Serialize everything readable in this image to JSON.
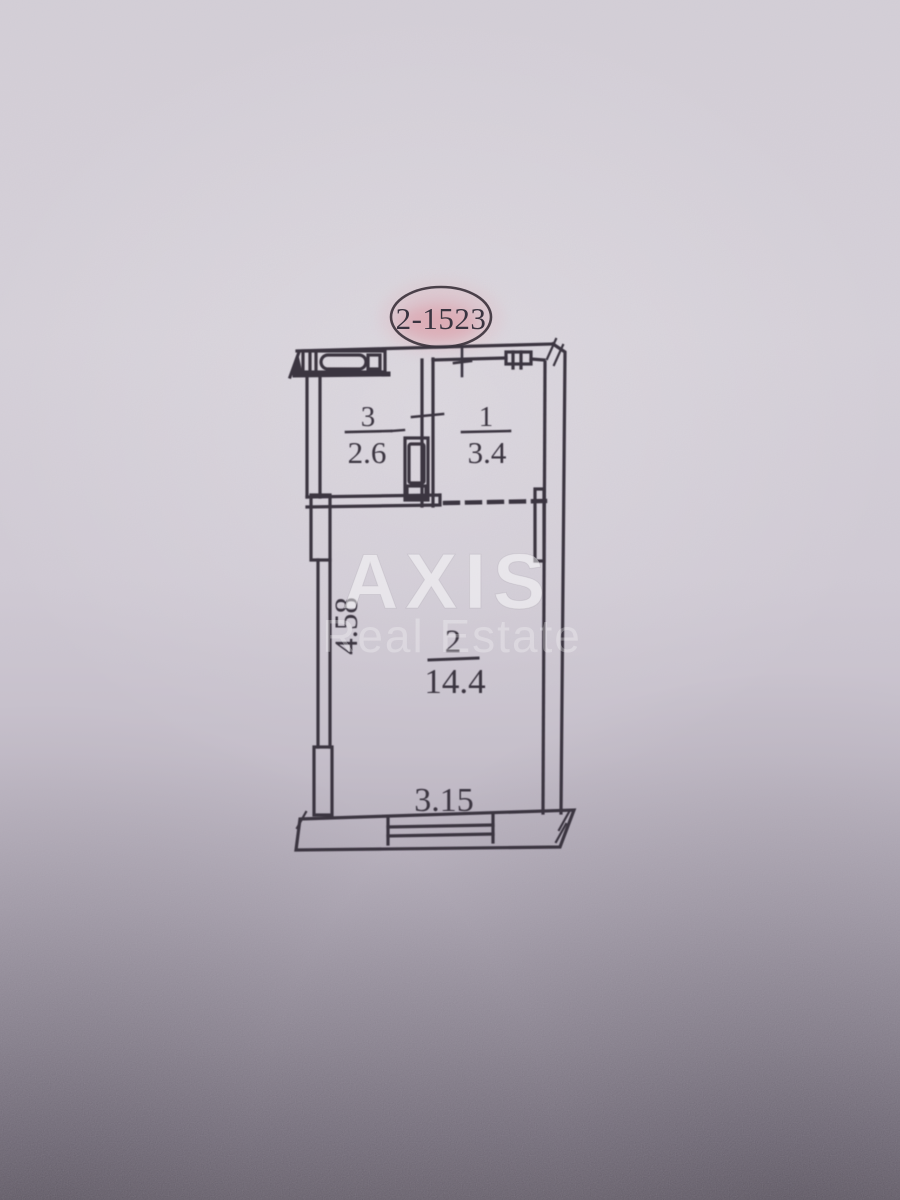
{
  "plan": {
    "unit_label": "2-1523",
    "rooms": {
      "room1": {
        "number": "1",
        "area": "3.4"
      },
      "room2": {
        "number": "2",
        "area": "14.4"
      },
      "room3": {
        "number": "3",
        "area": "2.6"
      }
    },
    "dimensions": {
      "bottom_width": "3.15",
      "left_height": "4.58"
    },
    "watermark": {
      "title": "AXIS",
      "subtitle": "Real Estate"
    },
    "colors": {
      "ink": "#3a3440",
      "stamp_pink": "#d98894",
      "paper_light": "#d8d3db",
      "paper_shadow": "#6b646f"
    }
  }
}
